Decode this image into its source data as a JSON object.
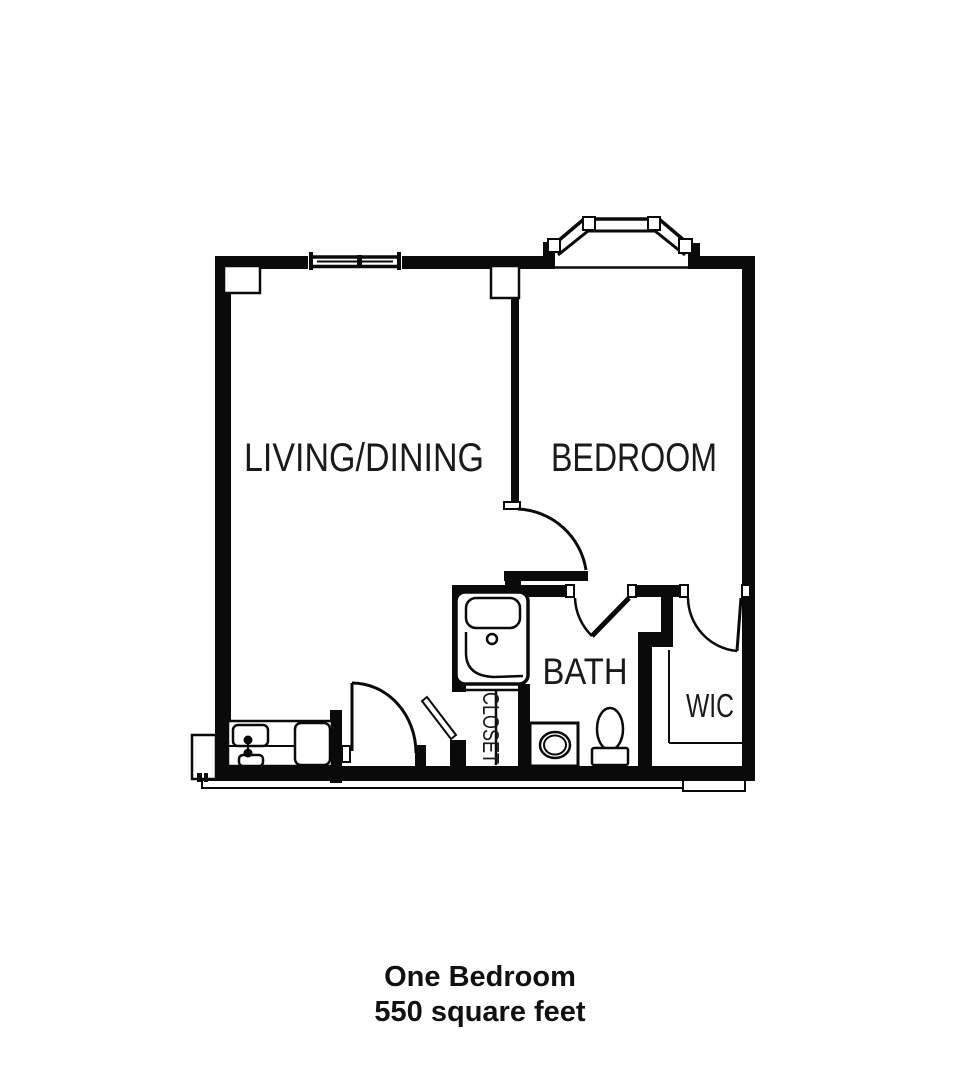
{
  "floor_plan": {
    "rooms": {
      "living": {
        "label": "LIVING/DINING"
      },
      "bedroom": {
        "label": "BEDROOM"
      },
      "bath": {
        "label": "BATH"
      },
      "wic": {
        "label": "WIC"
      },
      "closet": {
        "label": "CLOSET"
      }
    },
    "fixtures": [
      "bay-window",
      "window",
      "bathtub",
      "sink",
      "toilet",
      "kitchenette-counter",
      "entry-door",
      "bedroom-hall-door",
      "bath-door",
      "wic-door",
      "closet-door"
    ]
  },
  "caption": {
    "line1": "One Bedroom",
    "line2": "550 square feet"
  },
  "colors": {
    "walls": "#0a0a0a",
    "background": "#ffffff",
    "label_text": "#1a1a1a"
  }
}
